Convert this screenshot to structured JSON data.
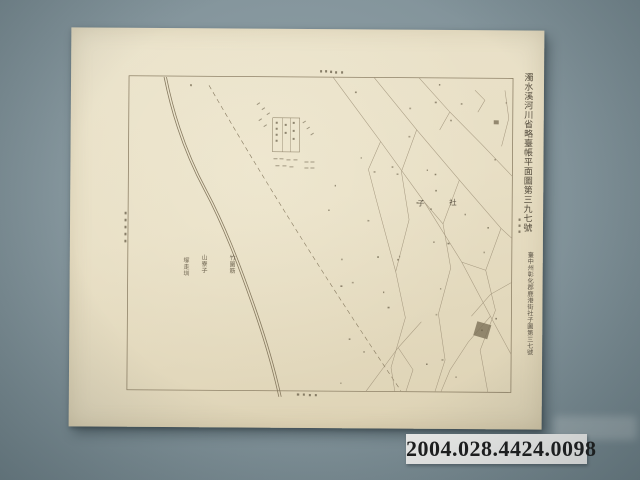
{
  "background": {
    "color": "#84959b"
  },
  "catalog_label": {
    "text": "2004.028.4424.0098",
    "bg_color": "#ececea",
    "text_color": "#1d1d1d"
  },
  "map_sheet": {
    "paper_color": "#e8dfc5",
    "ink_color": "#8a7d63",
    "title_vertical": "濁水溪河川省略臺帳平面圖第三九七號",
    "subtitle_vertical": "臺中州彰化郡鹿港街社子圖第三七號",
    "area_label": "社子",
    "village_labels": [
      "竹圍筋",
      "山寮子",
      "塚走圳"
    ]
  }
}
